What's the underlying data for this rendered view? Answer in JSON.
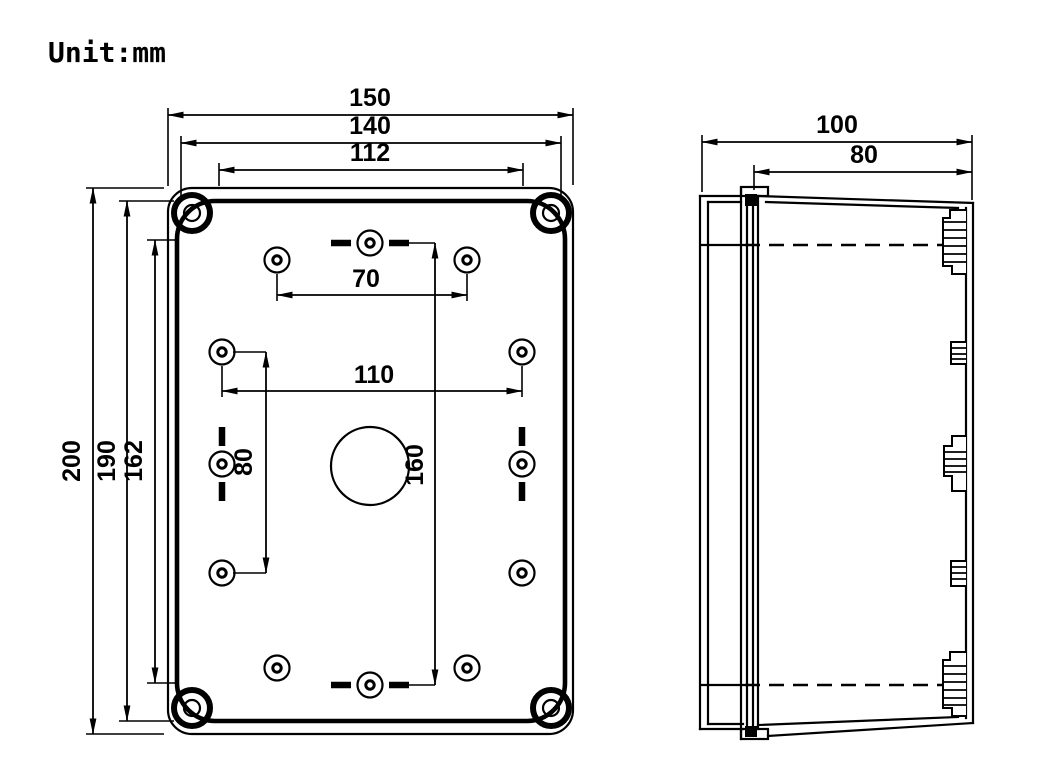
{
  "unit_label": "Unit:mm",
  "drawing": {
    "type": "technical-drawing",
    "subject": "enclosure box, front view and side view",
    "line_color": "#000000",
    "background_color": "#ffffff"
  },
  "dims": {
    "overall_width": "150",
    "lid_width": "140",
    "top_hole_span": "112",
    "overall_height": "200",
    "lid_height": "190",
    "inner_height": "162",
    "top_hole_pitch": "70",
    "mid_hole_pitch": "110",
    "left_hole_pitch_vertical": "80",
    "center_hole_pitch_vertical": "160",
    "overall_depth": "100",
    "body_depth": "80"
  }
}
